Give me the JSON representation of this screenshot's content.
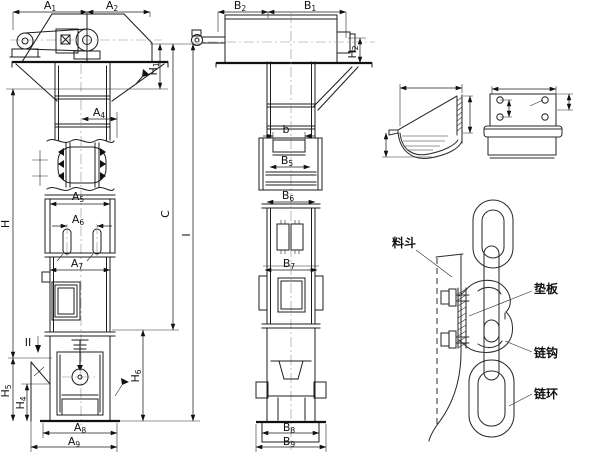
{
  "colors": {
    "line": "#1c1c1c",
    "background": "#ffffff",
    "centerline": "#8f8f8f"
  },
  "dimensions": {
    "a1": {
      "base": "A",
      "sub": "1"
    },
    "a2": {
      "base": "A",
      "sub": "2"
    },
    "a4": {
      "base": "A",
      "sub": "4"
    },
    "a5": {
      "base": "A",
      "sub": "5"
    },
    "a6": {
      "base": "A",
      "sub": "6"
    },
    "a7": {
      "base": "A",
      "sub": "7"
    },
    "a8": {
      "base": "A",
      "sub": "8"
    },
    "a9": {
      "base": "A",
      "sub": "9"
    },
    "b1": {
      "base": "B",
      "sub": "1"
    },
    "b2": {
      "base": "B",
      "sub": "2"
    },
    "b5": {
      "base": "B",
      "sub": "5"
    },
    "b6": {
      "base": "B",
      "sub": "6"
    },
    "b7": {
      "base": "B",
      "sub": "7"
    },
    "b8": {
      "base": "B",
      "sub": "8"
    },
    "b9": {
      "base": "B",
      "sub": "9"
    },
    "b_small": {
      "base": "b",
      "sub": ""
    },
    "h1": {
      "base": "H",
      "sub": "1"
    },
    "h2": {
      "base": "H",
      "sub": "2"
    },
    "h4": {
      "base": "H",
      "sub": "4"
    },
    "h5": {
      "base": "H",
      "sub": "5"
    },
    "h6": {
      "base": "H",
      "sub": "6"
    },
    "h": {
      "base": "H",
      "sub": ""
    },
    "c": {
      "base": "C",
      "sub": ""
    },
    "i": {
      "base": "I",
      "sub": ""
    },
    "section_ii": {
      "base": "II",
      "sub": ""
    }
  },
  "callouts": {
    "hopper": "料斗",
    "pad_plate": "垫板",
    "chain_hook": "链钩",
    "chain_ring": "链环"
  }
}
